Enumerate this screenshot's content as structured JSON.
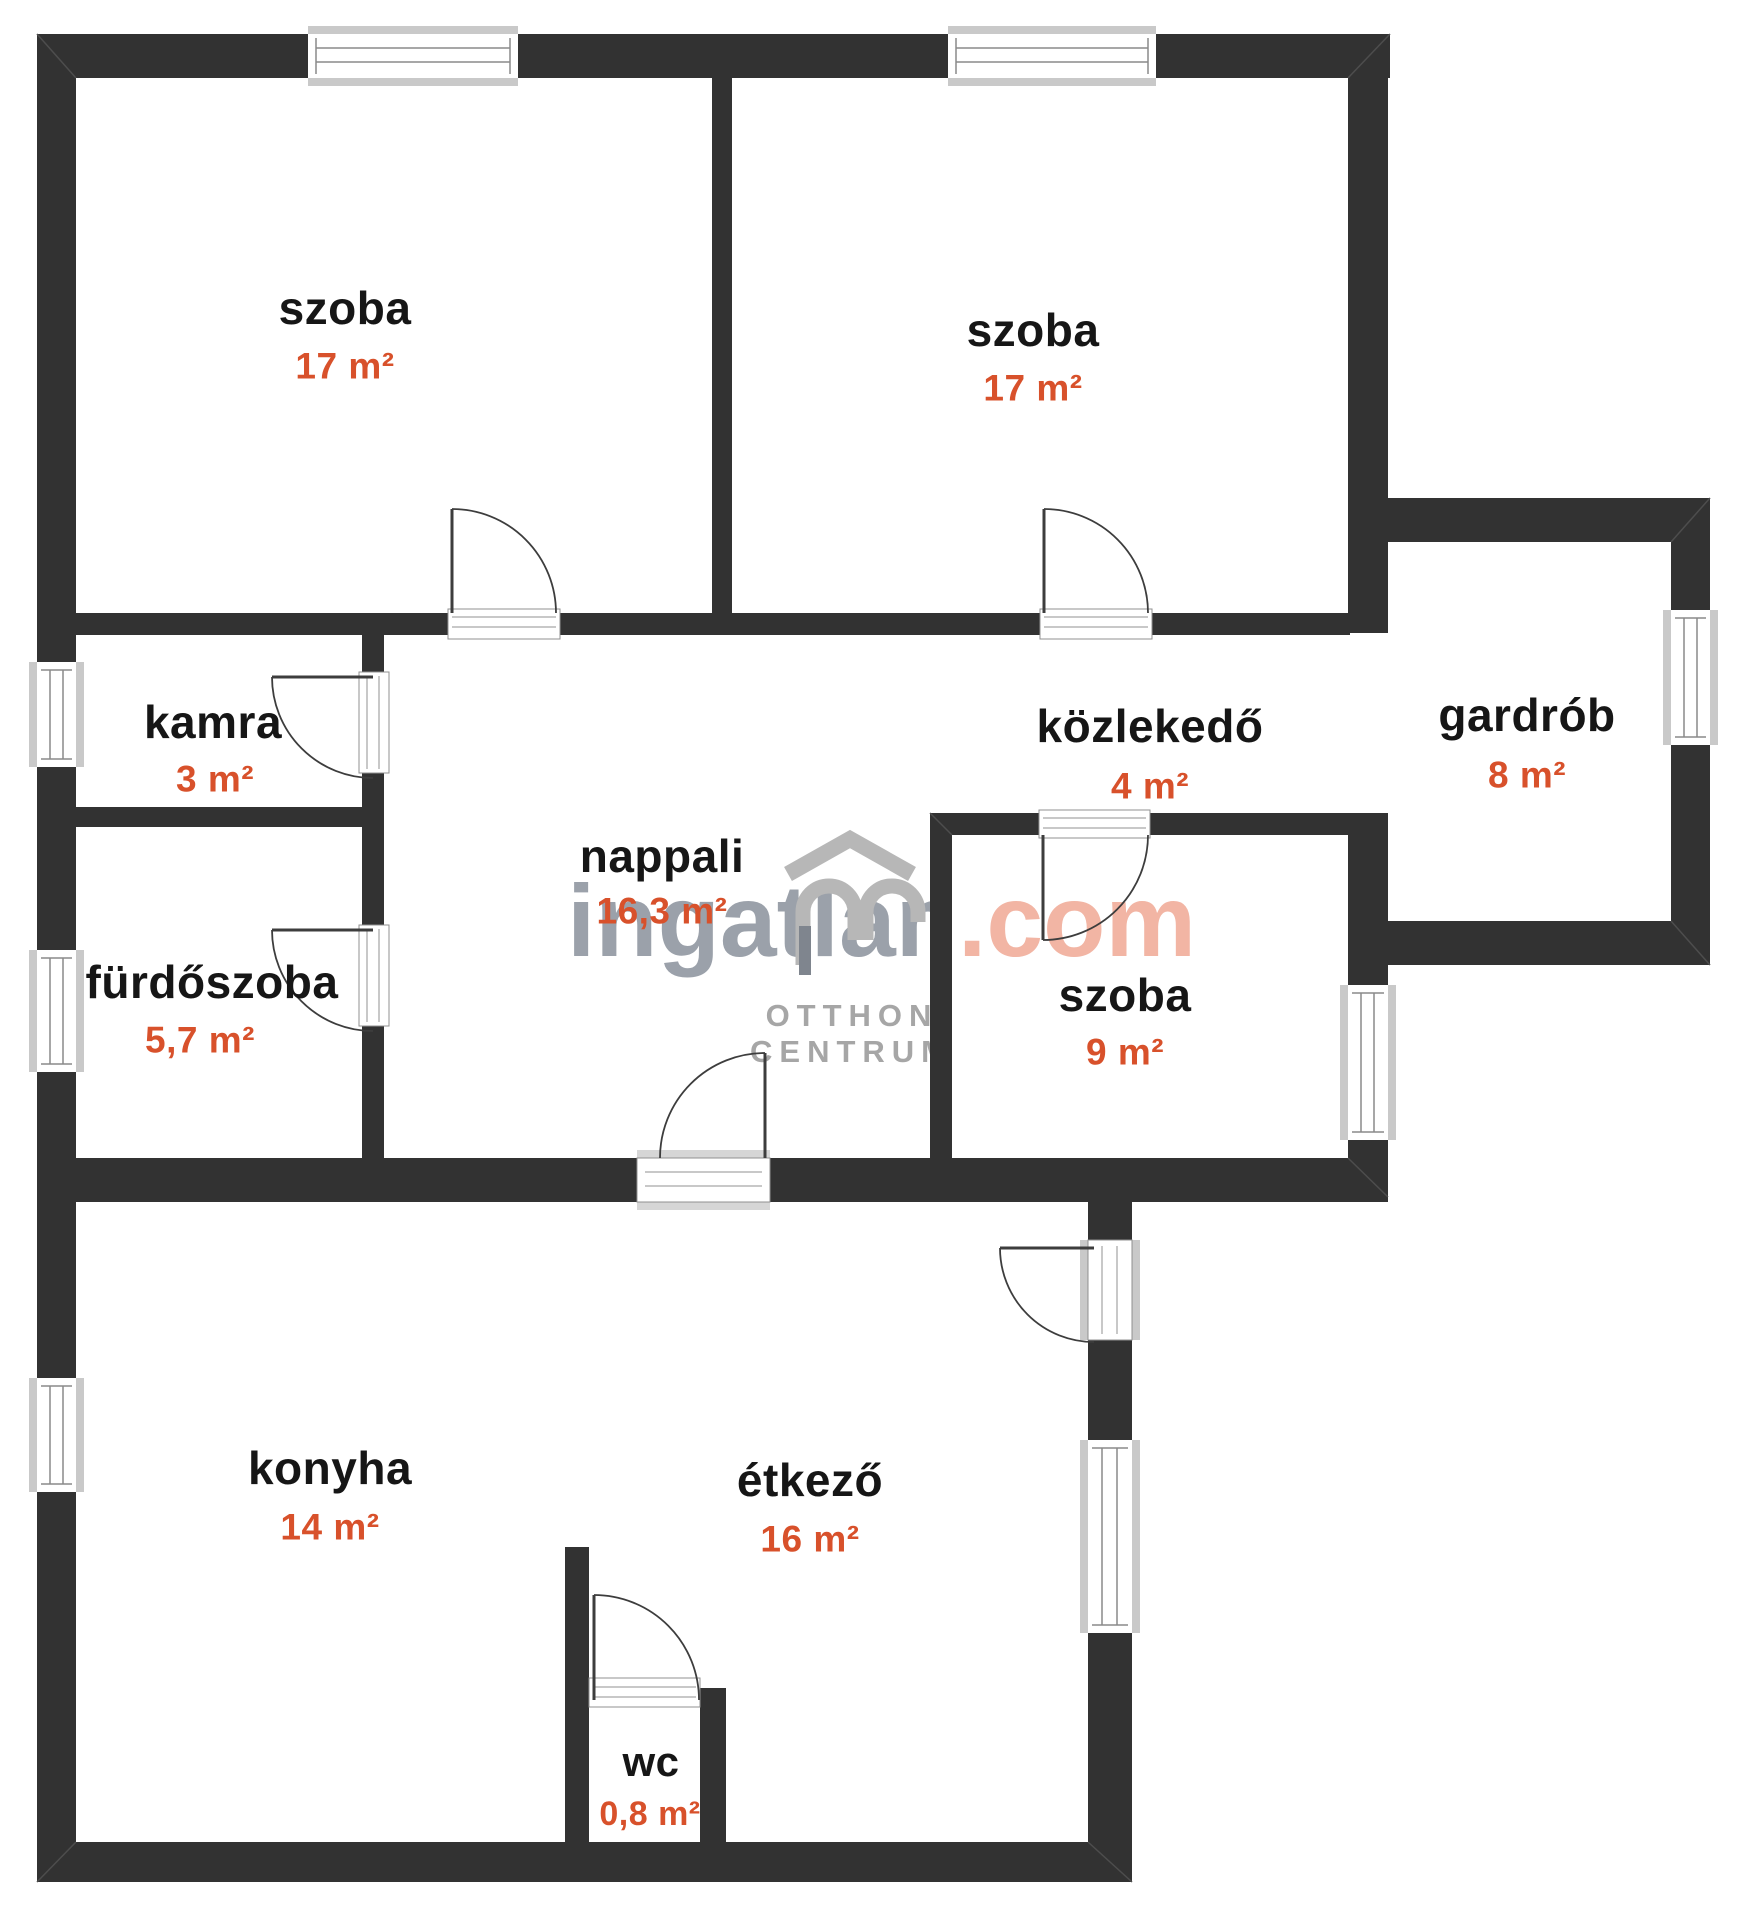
{
  "page": {
    "background": "#ffffff",
    "type": "apartment floor plan"
  },
  "colors": {
    "wall": "#323232",
    "room_name_text": "#161616",
    "area_text": "#d8512b",
    "window_frame": "#c9c9c9",
    "door_line": "#3d3d3d",
    "watermark_gray": "#9ba1aa",
    "watermark_salmon": "#f2b5a4",
    "logo_gray": "#b7b7b7",
    "agency_text_gray": "#a6a6a6"
  },
  "rooms": [
    {
      "name": "szoba",
      "area": "17 m²"
    },
    {
      "name": "szoba",
      "area": "17 m²"
    },
    {
      "name": "kamra",
      "area": "3 m²"
    },
    {
      "name": "fürdőszoba",
      "area": "5,7 m²"
    },
    {
      "name": "nappali",
      "area": "16,3 m²"
    },
    {
      "name": "közlekedő",
      "area": "4 m²"
    },
    {
      "name": "gardrób",
      "area": "8 m²"
    },
    {
      "name": "szoba",
      "area": "9 m²"
    },
    {
      "name": "konyha",
      "area": "14 m²"
    },
    {
      "name": "étkező",
      "area": "16 m²"
    },
    {
      "name": "wc",
      "area": "0,8 m²"
    }
  ],
  "watermark": {
    "brand_name": "ingatlan",
    "brand_tld": ".com",
    "agency_line1": "OTTHON",
    "agency_line2": "CENTRUM"
  }
}
